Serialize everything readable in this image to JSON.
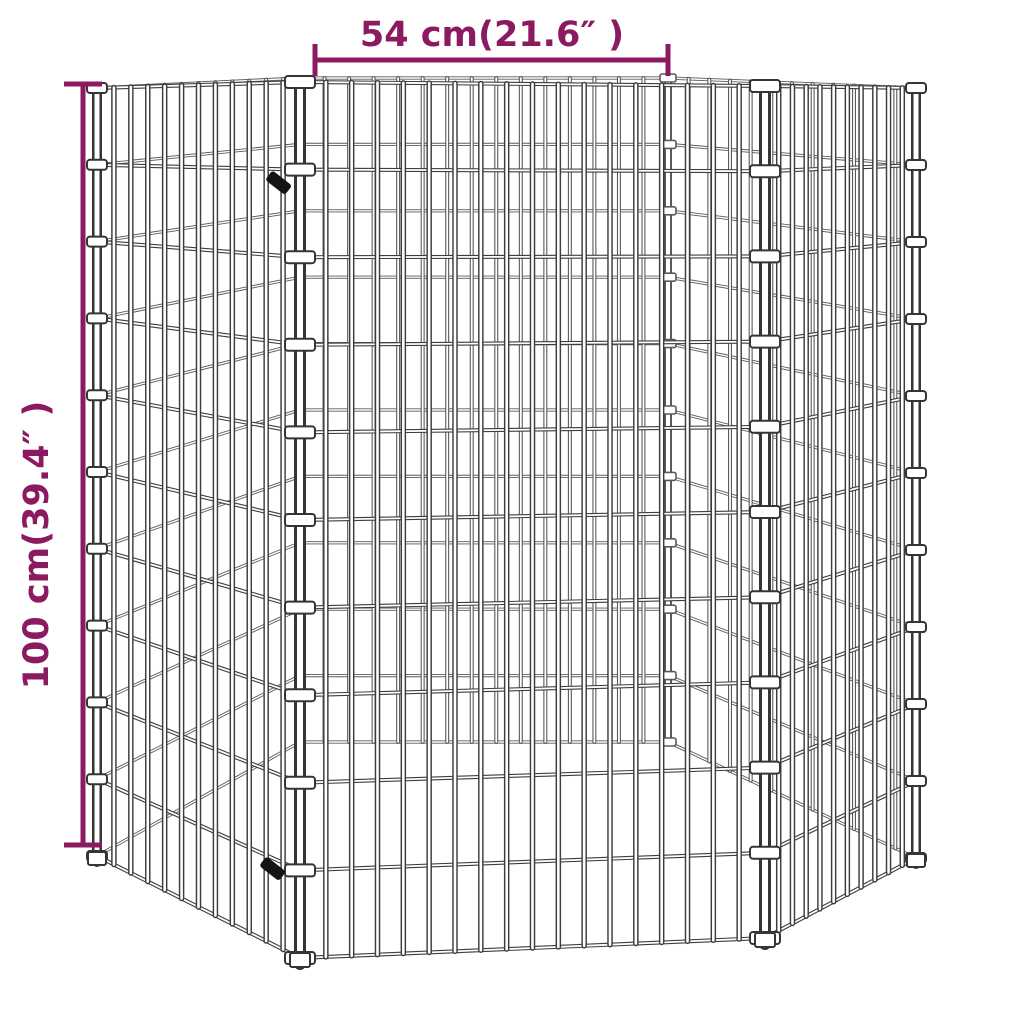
{
  "background": "#ffffff",
  "dimensions": {
    "width_label": "54 cm(21.6″ )",
    "height_label": "100 cm(39.4″ )",
    "accent_color": "#8b1a60"
  },
  "cage": {
    "front_wire_color": "#3d3d3d",
    "back_wire_color": "#5a5a5a",
    "post_color": "#353535",
    "core_color": "#ffffff",
    "clip_fill": "#ffffff",
    "latch_color": "#141414"
  }
}
